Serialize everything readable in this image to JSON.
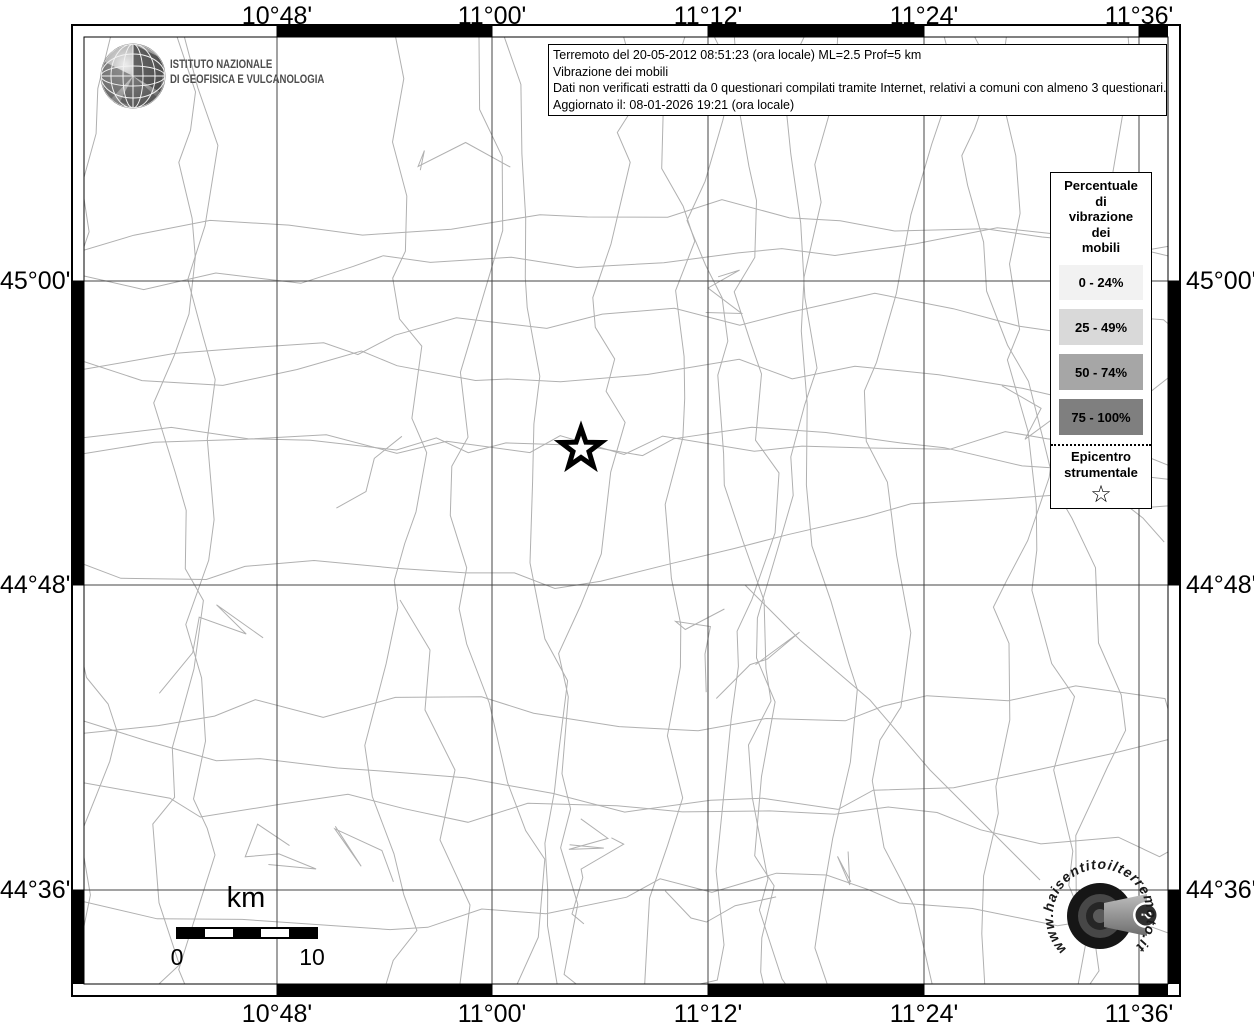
{
  "info_box": {
    "line1": "Terremoto del 20-05-2012 08:51:23 (ora locale) ML=2.5 Prof=5 km",
    "line2": "Vibrazione dei mobili",
    "line3": "Dati non verificati estratti da 0 questionari compilati tramite Internet, relativi a comuni con almeno 3 questionari.",
    "line4": "Aggiornato il: 08-01-2026 19:21 (ora locale)"
  },
  "ingv": {
    "line1": "ISTITUTO NAZIONALE",
    "line2": "DI GEOFISICA E VULCANOLOGIA"
  },
  "axis": {
    "top": [
      "10°48'",
      "11°00'",
      "11°12'",
      "11°24'",
      "11°36'"
    ],
    "bottom": [
      "10°48'",
      "11°00'",
      "11°12'",
      "11°24'",
      "11°36'"
    ],
    "left": [
      "45°00'",
      "44°48'",
      "44°36'"
    ],
    "right": [
      "45°00'",
      "44°48'",
      "44°36'"
    ]
  },
  "legend": {
    "title_lines": [
      "Percentuale",
      "di",
      "vibrazione",
      "dei",
      "mobili"
    ],
    "classes": [
      {
        "label": "0 - 24%",
        "color": "#f2f2f2"
      },
      {
        "label": "25 - 49%",
        "color": "#d9d9d9"
      },
      {
        "label": "50 - 74%",
        "color": "#a6a6a6"
      },
      {
        "label": "75 - 100%",
        "color": "#7f7f7f"
      }
    ],
    "epicenter_line1": "Epicentro",
    "epicenter_line2": "strumentale",
    "epicenter_symbol": "☆"
  },
  "scalebar": {
    "unit": "km",
    "start": "0",
    "end": "10"
  },
  "watermark": {
    "url_text": "www.haisentitoilterremoto.it",
    "badge": "?"
  },
  "colors": {
    "frame": "#000000",
    "gridline": "#444444",
    "boundary": "#b0b0b0",
    "map_background": "#ffffff"
  }
}
